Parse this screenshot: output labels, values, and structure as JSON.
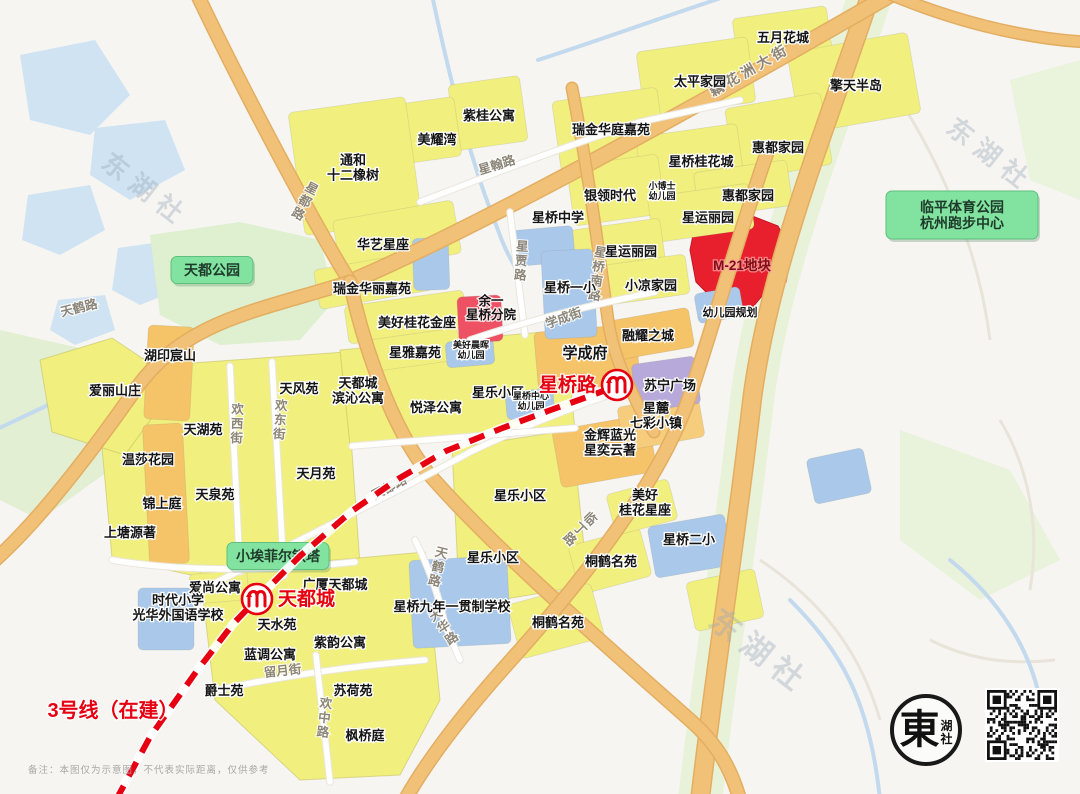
{
  "colors": {
    "metro_red": "#e60012",
    "green_poi_fill": "#82e2a0",
    "block_red": "#e8202e",
    "block_pink": "#ee5163",
    "watermark": "#9aa7b8"
  },
  "watermark": {
    "text": "东湖社",
    "instances": [
      {
        "x": 140,
        "y": 197,
        "size": 26,
        "rotate": 38
      },
      {
        "x": 985,
        "y": 162,
        "size": 26,
        "rotate": 38
      },
      {
        "x": 753,
        "y": 660,
        "size": 31,
        "rotate": 38
      }
    ]
  },
  "metro": {
    "line_label": "3号线（在建）",
    "line_label_x": 113,
    "line_label_y": 717,
    "stations": [
      {
        "name": "天都城",
        "x": 257,
        "y": 599,
        "side": "right"
      },
      {
        "name": "星桥路",
        "x": 617,
        "y": 385,
        "side": "left"
      }
    ]
  },
  "green_pois": [
    {
      "lines": [
        "天都公园"
      ],
      "x": 212,
      "y": 270,
      "w": 82,
      "h": 27
    },
    {
      "lines": [
        "小埃菲尔铁塔"
      ],
      "x": 278,
      "y": 556,
      "w": 102,
      "h": 27
    },
    {
      "lines": [
        "临平体育公园",
        "杭州跑步中心"
      ],
      "x": 962,
      "y": 215,
      "w": 152,
      "h": 48
    }
  ],
  "special_labels": [
    {
      "t": "M-21地块",
      "x": 742,
      "y": 270,
      "s": 13.5,
      "c": "#7d0d16",
      "halo": "rgba(255,160,160,0.75)"
    },
    {
      "lines": [
        "余一",
        "星桥分院"
      ],
      "x": 491,
      "y": 312,
      "s": 12.5,
      "c": "#141414",
      "halo": "rgba(255,255,255,0.85)"
    }
  ],
  "area_labels": [
    {
      "t": "五月花城",
      "x": 783,
      "y": 42
    },
    {
      "t": "太平家园",
      "x": 700,
      "y": 86
    },
    {
      "t": "擎天半岛",
      "x": 856,
      "y": 90
    },
    {
      "t": "紫桂公寓",
      "x": 489,
      "y": 120
    },
    {
      "t": "美耀湾",
      "x": 437,
      "y": 144
    },
    {
      "t": "瑞金华庭嘉苑",
      "x": 611,
      "y": 134
    },
    {
      "lines": [
        "通和",
        "十二橡树"
      ],
      "x": 353,
      "y": 172
    },
    {
      "t": "惠都家园",
      "x": 778,
      "y": 152
    },
    {
      "t": "星桥桂花城",
      "x": 701,
      "y": 166
    },
    {
      "t": "惠都家园",
      "x": 748,
      "y": 200
    },
    {
      "t": "银领时代",
      "x": 610,
      "y": 200
    },
    {
      "lines": [
        "小博士",
        "幼儿园"
      ],
      "x": 662,
      "y": 194,
      "s": 9
    },
    {
      "t": "星运丽园",
      "x": 708,
      "y": 222
    },
    {
      "t": "星运丽园",
      "x": 631,
      "y": 256
    },
    {
      "t": "星桥中学",
      "x": 558,
      "y": 222
    },
    {
      "t": "星桥一小",
      "x": 570,
      "y": 292
    },
    {
      "t": "小凉家园",
      "x": 651,
      "y": 290
    },
    {
      "t": "幼儿园规划",
      "x": 730,
      "y": 316,
      "s": 11
    },
    {
      "t": "华艺星座",
      "x": 383,
      "y": 249
    },
    {
      "t": "瑞金华丽嘉苑",
      "x": 372,
      "y": 293
    },
    {
      "t": "美好桂花金座",
      "x": 417,
      "y": 327
    },
    {
      "t": "星雅嘉苑",
      "x": 415,
      "y": 357
    },
    {
      "lines": [
        "美好晨晖",
        "幼儿园"
      ],
      "x": 471,
      "y": 353,
      "s": 9
    },
    {
      "t": "学成府",
      "x": 585,
      "y": 358,
      "s": 15
    },
    {
      "t": "融耀之城",
      "x": 648,
      "y": 340
    },
    {
      "t": "苏宁广场",
      "x": 670,
      "y": 390
    },
    {
      "lines": [
        "星麓",
        "七彩小镇"
      ],
      "x": 656,
      "y": 420
    },
    {
      "lines": [
        "金辉蓝光",
        "星奕云著"
      ],
      "x": 610,
      "y": 447
    },
    {
      "t": "星乐小区",
      "x": 498,
      "y": 397
    },
    {
      "lines": [
        "星桥中心",
        "幼儿园"
      ],
      "x": 531,
      "y": 404,
      "s": 9
    },
    {
      "t": "悦泽公寓",
      "x": 436,
      "y": 412
    },
    {
      "lines": [
        "天都城",
        "滨沁公寓"
      ],
      "x": 358,
      "y": 395
    },
    {
      "t": "天风苑",
      "x": 299,
      "y": 393
    },
    {
      "t": "湖印宸山",
      "x": 170,
      "y": 360
    },
    {
      "t": "爱丽山庄",
      "x": 115,
      "y": 395
    },
    {
      "t": "天湖苑",
      "x": 203,
      "y": 434
    },
    {
      "t": "温莎花园",
      "x": 148,
      "y": 464
    },
    {
      "t": "天月苑",
      "x": 316,
      "y": 478
    },
    {
      "t": "天泉苑",
      "x": 215,
      "y": 499
    },
    {
      "t": "锦上庭",
      "x": 162,
      "y": 508
    },
    {
      "t": "上塘源著",
      "x": 130,
      "y": 537
    },
    {
      "t": "星乐小区",
      "x": 520,
      "y": 500
    },
    {
      "t": "星乐小区",
      "x": 493,
      "y": 562
    },
    {
      "lines": [
        "美好",
        "桂花星座"
      ],
      "x": 645,
      "y": 507
    },
    {
      "t": "星桥二小",
      "x": 689,
      "y": 544
    },
    {
      "t": "桐鹤名苑",
      "x": 611,
      "y": 566
    },
    {
      "t": "桐鹤名苑",
      "x": 558,
      "y": 627
    },
    {
      "t": "星桥九年一贯制学校",
      "x": 452,
      "y": 611,
      "s": 13
    },
    {
      "t": "爱尚公寓",
      "x": 215,
      "y": 592
    },
    {
      "lines": [
        "时代小学",
        "光华外国语学校"
      ],
      "x": 178,
      "y": 612
    },
    {
      "t": "广厦天都城",
      "x": 335,
      "y": 589
    },
    {
      "t": "天水苑",
      "x": 277,
      "y": 629
    },
    {
      "t": "蓝调公寓",
      "x": 270,
      "y": 659
    },
    {
      "t": "紫韵公寓",
      "x": 340,
      "y": 647
    },
    {
      "t": "爵士苑",
      "x": 224,
      "y": 695
    },
    {
      "t": "苏荷苑",
      "x": 353,
      "y": 695
    },
    {
      "t": "枫桥庭",
      "x": 365,
      "y": 740
    }
  ],
  "road_labels": [
    {
      "t": "藕花洲大街",
      "x": 752,
      "y": 74,
      "r": -30,
      "s": 14,
      "sp": 4
    },
    {
      "t": "星翰路",
      "x": 498,
      "y": 169,
      "r": -17
    },
    {
      "t": "星都路",
      "x": 303,
      "y": 205,
      "v": 1,
      "r": 28
    },
    {
      "t": "天鹤路",
      "x": 80,
      "y": 312,
      "r": -14
    },
    {
      "t": "星贾路",
      "x": 521,
      "y": 265,
      "v": 1,
      "r": 4
    },
    {
      "t": "星桥南路",
      "x": 597,
      "y": 278,
      "v": 1,
      "r": 8
    },
    {
      "t": "学成街",
      "x": 565,
      "y": 322,
      "r": -20
    },
    {
      "t": "天都路",
      "x": 391,
      "y": 491,
      "r": -28
    },
    {
      "t": "欢西街",
      "x": 237,
      "y": 428,
      "v": 1,
      "r": 2
    },
    {
      "t": "欢东街",
      "x": 280,
      "y": 424,
      "v": 1,
      "r": 4
    },
    {
      "t": "临丁路",
      "x": 577,
      "y": 532,
      "v": 1,
      "r": 45
    },
    {
      "t": "天华路",
      "x": 446,
      "y": 630,
      "v": 1,
      "r": -34
    },
    {
      "t": "留月街",
      "x": 283,
      "y": 675,
      "r": -6
    },
    {
      "t": "欢中路",
      "x": 324,
      "y": 722,
      "v": 1,
      "r": 6
    },
    {
      "t": "天鹤路",
      "x": 437,
      "y": 571,
      "v": 1,
      "r": 14
    }
  ],
  "footer": {
    "disclaimer": "备注：本图仅为示意图，不代表实际距离，仅供参考",
    "logo_main": "東",
    "logo_sub1": "湖",
    "logo_sub2": "社"
  }
}
